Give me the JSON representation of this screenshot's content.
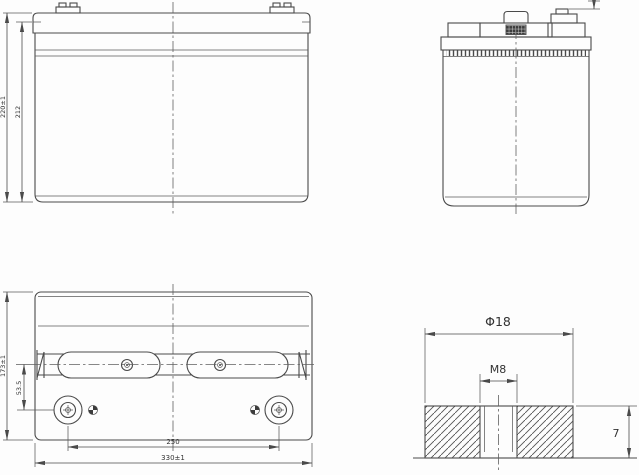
{
  "title": "battery-dimension-drawing",
  "colors": {
    "line": "#4a4a4a",
    "text": "#333333",
    "background": "#fdfdfd"
  },
  "front_view": {
    "dim_overall_height": "220±1",
    "dim_case_height": "212"
  },
  "top_view": {
    "dim_depth": "173±1",
    "dim_terminal_offset": "53.5",
    "dim_terminal_spacing": "250",
    "dim_overall_length": "330±1"
  },
  "terminal_detail": {
    "dim_terminal_diameter": "Φ18",
    "dim_thread_size": "M8",
    "dim_terminal_height": "7"
  }
}
